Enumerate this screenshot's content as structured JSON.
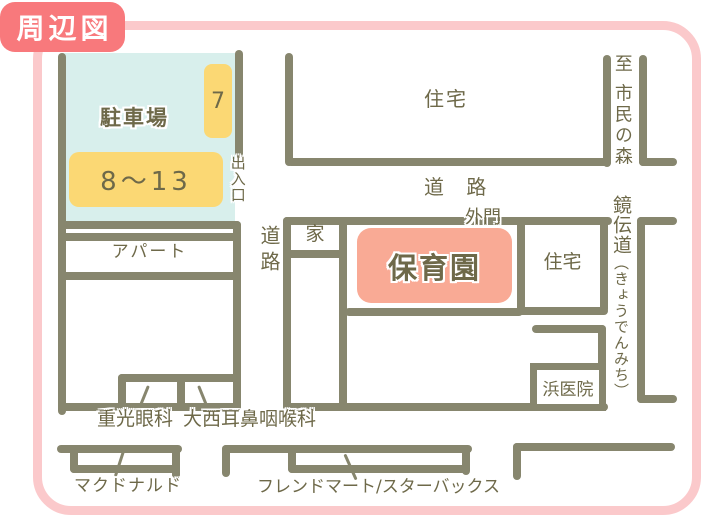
{
  "badge": {
    "title": "周辺図"
  },
  "parking": {
    "name": "駐車場",
    "spot_7": "7",
    "spot_8_13": "8～13",
    "gate": "出入口"
  },
  "roads": {
    "left_vertical": "道路",
    "top_horizontal": "道 路",
    "to_destination": "至 市民の森",
    "named_road": "鏡伝道",
    "named_road_kana": "（きょうでんみち）"
  },
  "places": {
    "housing_top": "住宅",
    "housing_right": "住宅",
    "house": "家",
    "apartment": "アパート",
    "nursery_school": "保育園",
    "outer_gate": "外門",
    "hama_clinic": "浜医院",
    "eye_clinic": "重光眼科",
    "ent_clinic": "大西耳鼻咽喉科",
    "mcdonalds": "マクドナルド",
    "friend_mart_starbucks": "フレンドマート/スターバックス"
  },
  "colors": {
    "frame_pink": "#fbc9cb",
    "badge_red": "#f8797c",
    "road_olive": "#87866e",
    "text_olive": "#6e6949",
    "parking_blue": "#d8efec",
    "spot_yellow": "#fbd874",
    "nursery_salmon": "#f9aa95"
  }
}
